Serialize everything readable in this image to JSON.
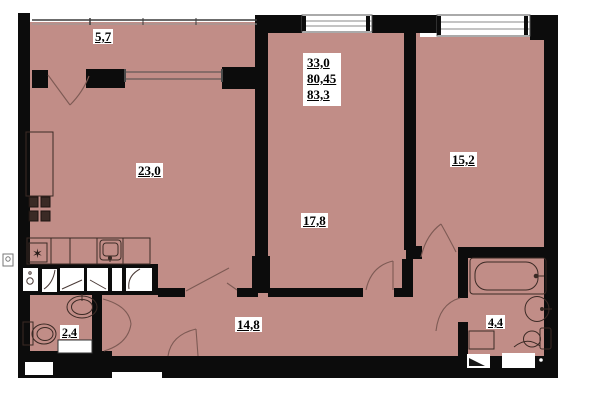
{
  "title": "apartment floor plan",
  "colors": {
    "room_fill": "#c18d87",
    "wall": "#0c0c0c",
    "background": "#ffffff",
    "label_bg": "#ffffff",
    "label_text": "#000000"
  },
  "summary": {
    "living_area": "33,0",
    "apartment_area": "80,45",
    "total_area": "83,3"
  },
  "rooms": {
    "balcony": {
      "area": "5,7"
    },
    "living_kitchen": {
      "area": "23,0"
    },
    "room_center": {
      "area": "17,8"
    },
    "room_right": {
      "area": "15,2"
    },
    "hall": {
      "area": "14,8"
    },
    "wc": {
      "area": "2,4"
    },
    "bathroom": {
      "area": "4,4"
    }
  },
  "fixtures": [
    "stove-icon",
    "kitchen-cabinet-icon",
    "kitchen-sink-icon",
    "hob-star-icon",
    "wardrobe-icon",
    "wash-basin-icon",
    "toilet-icon",
    "bathtub-icon",
    "washing-machine-icon",
    "shower-tray-icon",
    "vent-shaft-icon"
  ]
}
